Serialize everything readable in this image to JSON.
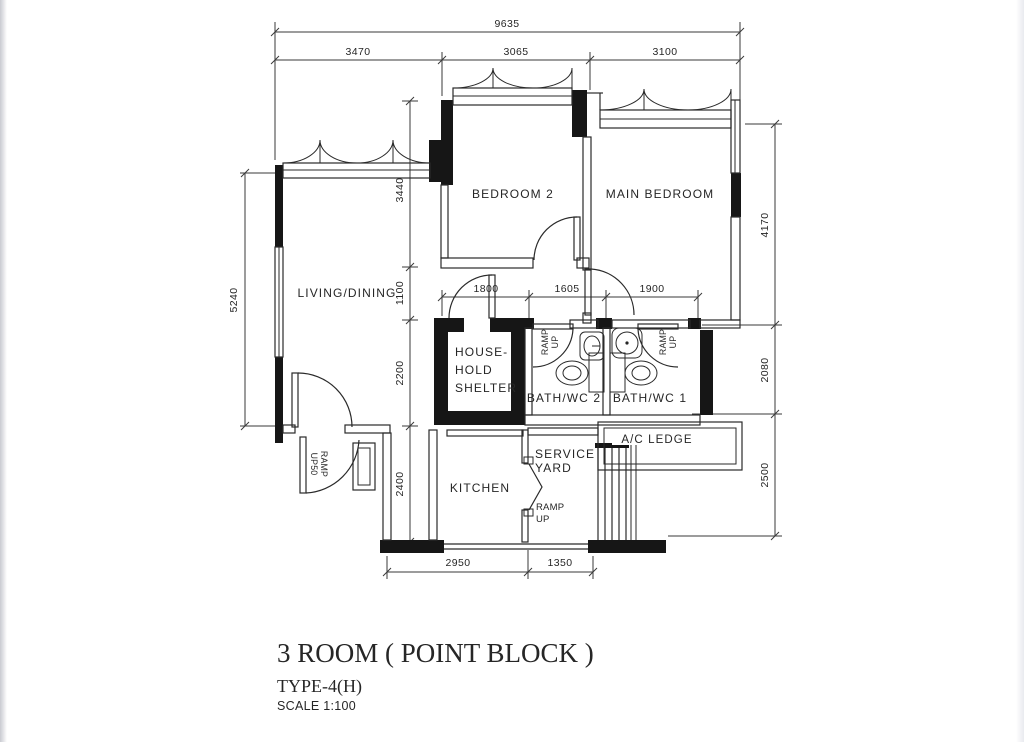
{
  "page": {
    "background": "#ffffff",
    "edge_strip_left": "#c9cad1",
    "edge_strip_right": "#e9eaef",
    "line_color": "#262626"
  },
  "title_block": {
    "title": "3 ROOM ( POINT BLOCK )",
    "type_label": "TYPE-4(H)",
    "scale_label": "SCALE 1:100"
  },
  "rooms": {
    "living_dining": "LIVING/DINING",
    "bedroom2": "BEDROOM 2",
    "main_bedroom": "MAIN BEDROOM",
    "household_shelter": {
      "line1": "HOUSE-",
      "line2": "HOLD",
      "line3": "SHELTER"
    },
    "bath2": "BATH/WC 2",
    "bath1": "BATH/WC 1",
    "kitchen": "KITCHEN",
    "service_yard": {
      "line1": "SERVICE",
      "line2": "YARD"
    },
    "ac_ledge": "A/C LEDGE"
  },
  "ramp_labels": {
    "entrance": {
      "line1": "RAMP",
      "line2": "UP50"
    },
    "bath2": {
      "line1": "RAMP",
      "line2": "UP"
    },
    "bath1": {
      "line1": "RAMP",
      "line2": "UP"
    },
    "service_yard": {
      "line1": "RAMP",
      "line2": "UP"
    }
  },
  "dimensions": {
    "top_overall": "9635",
    "top_left": "3470",
    "top_mid": "3065",
    "top_right": "3100",
    "left_overall": "5240",
    "inner_v1": "3440",
    "inner_v2": "1100",
    "inner_v3": "2200",
    "inner_v4": "2400",
    "right_v1": "4170",
    "right_v2": "2080",
    "right_v3": "2500",
    "mid_h1": "1800",
    "mid_h2": "1605",
    "mid_h3": "1900",
    "bottom_h1": "2950",
    "bottom_h2": "1350"
  }
}
